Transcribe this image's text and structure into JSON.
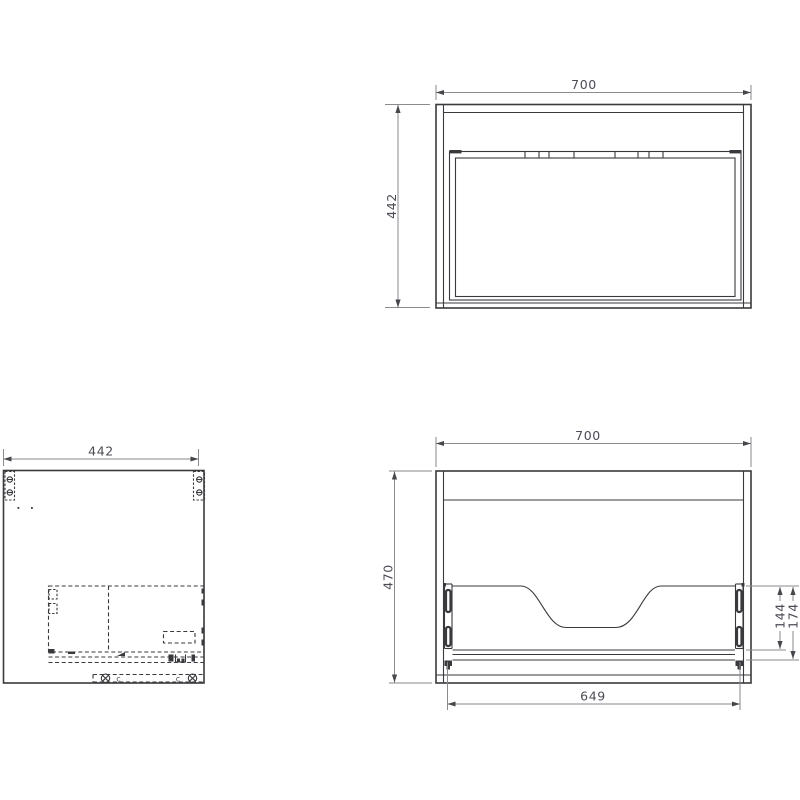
{
  "drawing": {
    "background": "#ffffff",
    "edge_color": "#3a3a3e",
    "dimension_line_color": "#8a8a8f",
    "dimension_text_color": "#4b4c55",
    "views": {
      "plan": {
        "width_label": "700",
        "depth_label": "442"
      },
      "side": {
        "depth_label": "442",
        "markers": [
          "c",
          "c"
        ]
      },
      "rear": {
        "width_label": "700",
        "height_label": "470",
        "inner_width_label": "649",
        "cutout_height_label": "144",
        "rail_height_label": "174"
      }
    }
  }
}
